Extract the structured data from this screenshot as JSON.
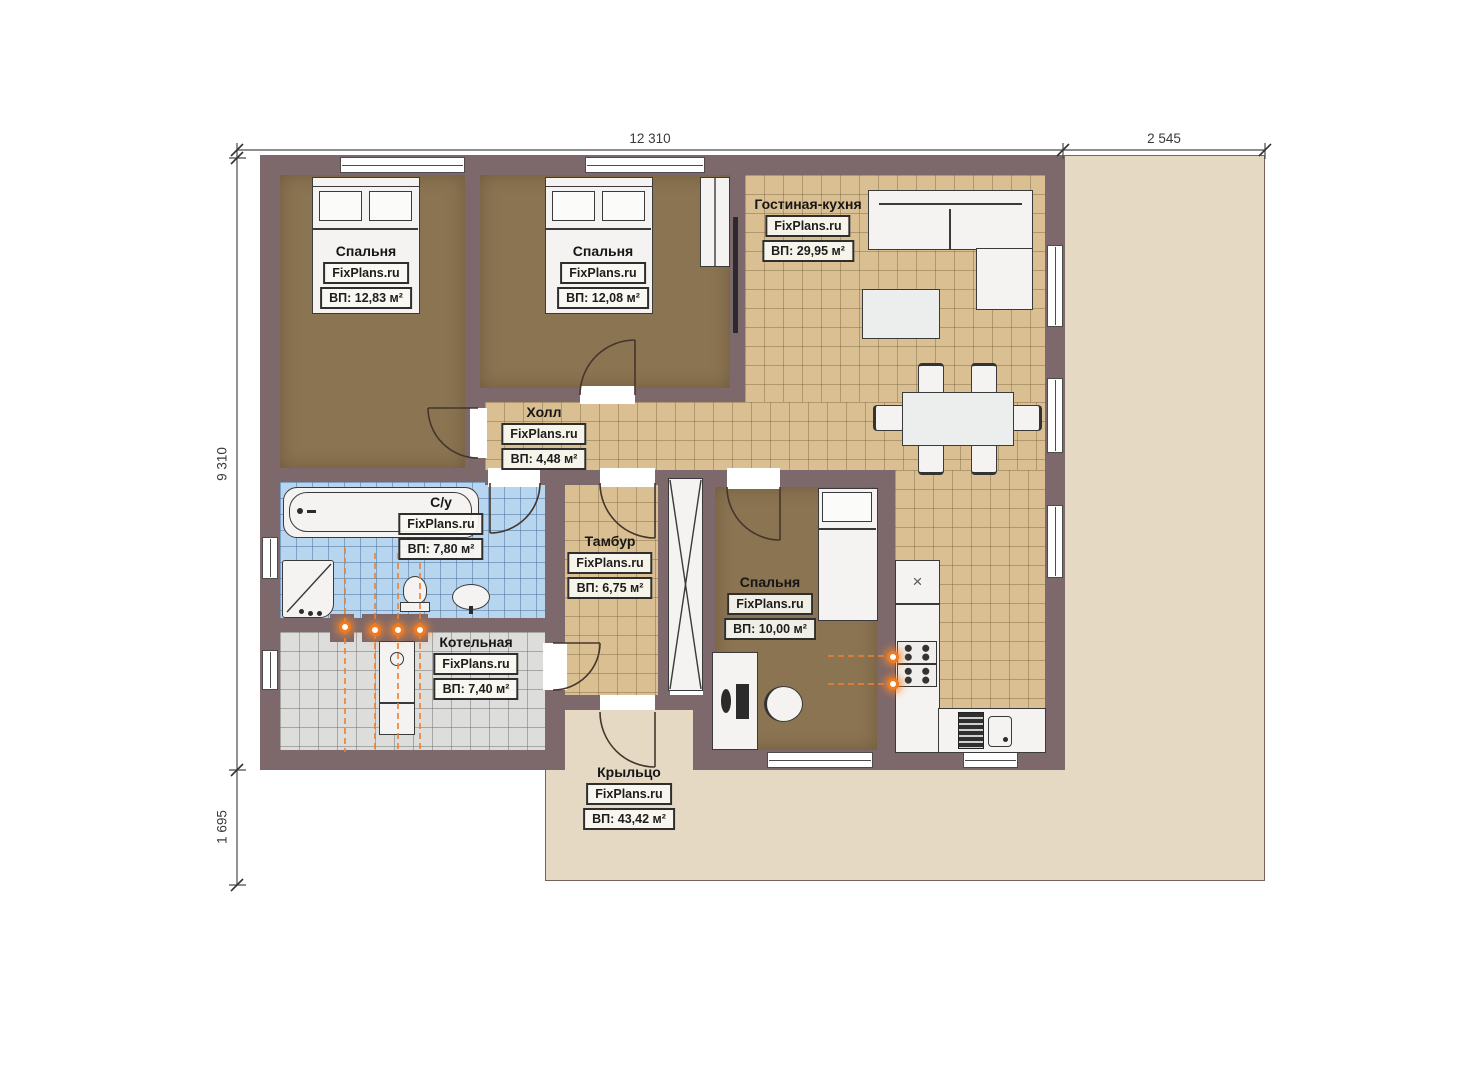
{
  "plan_title": "Одноэтажный дом — план этажа",
  "watermark": "FixPlans.ru",
  "dimensions": {
    "top_main": "12 310",
    "top_right": "2 545",
    "left_main": "9 310",
    "left_bottom": "1 695"
  },
  "rooms": [
    {
      "id": "bedroom-1",
      "name": "Спальня",
      "area": "ВП: 12,83 м²"
    },
    {
      "id": "bedroom-2",
      "name": "Спальня",
      "area": "ВП: 12,08 м²"
    },
    {
      "id": "living-kitchen",
      "name": "Гостиная-кухня",
      "area": "ВП: 29,95 м²"
    },
    {
      "id": "hall",
      "name": "Холл",
      "area": "ВП: 4,48 м²"
    },
    {
      "id": "bathroom",
      "name": "С/у",
      "area": "ВП: 7,80 м²"
    },
    {
      "id": "tambour",
      "name": "Тамбур",
      "area": "ВП: 6,75 м²"
    },
    {
      "id": "bedroom-3",
      "name": "Спальня",
      "area": "ВП: 10,00 м²"
    },
    {
      "id": "boiler-room",
      "name": "Котельная",
      "area": "ВП: 7,40 м²"
    },
    {
      "id": "porch",
      "name": "Крыльцо",
      "area": "ВП: 43,42 м²"
    }
  ],
  "colors": {
    "wall": "#7d696b",
    "bedroom_floor": "#8b7452",
    "tile_tan": "#d9bf92",
    "tile_blue": "#b8d5f0",
    "tile_gray": "#dddddb",
    "porch": "#e5d9c3",
    "heating_accent": "#f07a20"
  }
}
